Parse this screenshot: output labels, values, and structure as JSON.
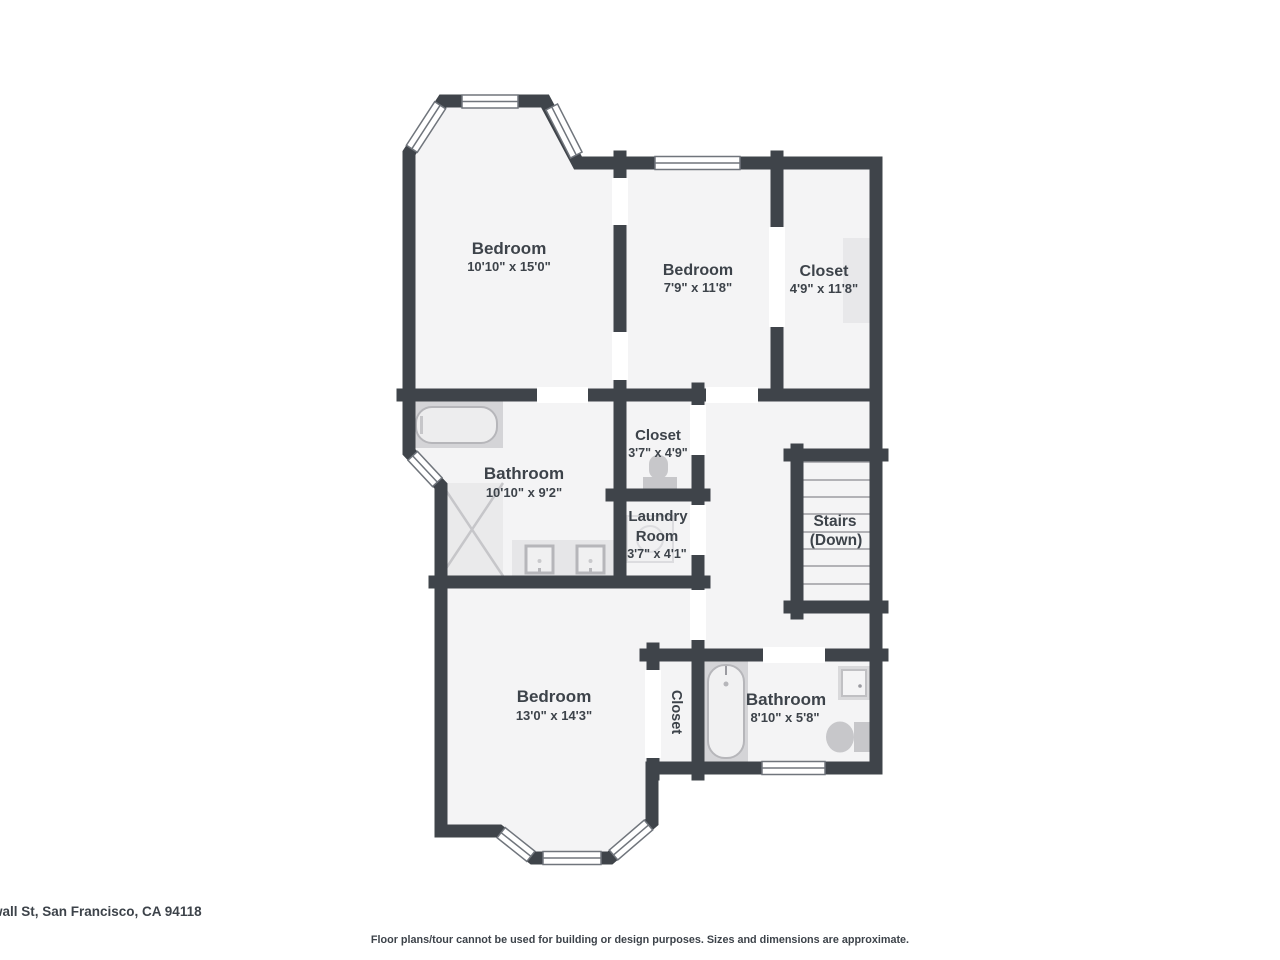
{
  "floorplan": {
    "rooms": {
      "bedroom_top_left": {
        "name": "Bedroom",
        "dims": "10'10\" x 15'0\""
      },
      "bedroom_top_middle": {
        "name": "Bedroom",
        "dims": "7'9\" x 11'8\""
      },
      "closet_top_right": {
        "name": "Closet",
        "dims": "4'9\" x 11'8\""
      },
      "bathroom_main": {
        "name": "Bathroom",
        "dims": "10'10\" x 9'2\""
      },
      "closet_toilet": {
        "name": "Closet",
        "dims": "3'7\" x 4'9\""
      },
      "laundry": {
        "name_line1": "Laundry",
        "name_line2": "Room",
        "dims": "3'7\" x 4'1\""
      },
      "stairs": {
        "label_line1": "Stairs",
        "label_line2": "(Down)"
      },
      "bedroom_bottom": {
        "name": "Bedroom",
        "dims": "13'0\" x 14'3\""
      },
      "closet_bottom": {
        "name": "Closet"
      },
      "bathroom_second": {
        "name": "Bathroom",
        "dims": "8'10\" x 5'8\""
      }
    },
    "icons": {
      "bathtub": "rounded-rect-tub-in-gray-surround",
      "shower": "square-with-x-cross",
      "sink": "square-basin-with-faucet-dot",
      "toilet": "tank-and-bowl-shape",
      "washer": "faint-square-with-circle",
      "window": "white-double-line-rect",
      "stairs": "parallel-treads"
    },
    "colors": {
      "wall": "#3f444a",
      "floor": "#f4f4f5",
      "fixture_light": "#eaeaeb",
      "fixture_mid": "#d4d4d7",
      "fixture_dark": "#c7c7ca",
      "text": "#3d434a",
      "background": "#ffffff"
    }
  },
  "footer": {
    "address": "wall St, San Francisco, CA 94118",
    "disclaimer": "Floor plans/tour cannot be used for building or design purposes. Sizes and dimensions are approximate."
  }
}
